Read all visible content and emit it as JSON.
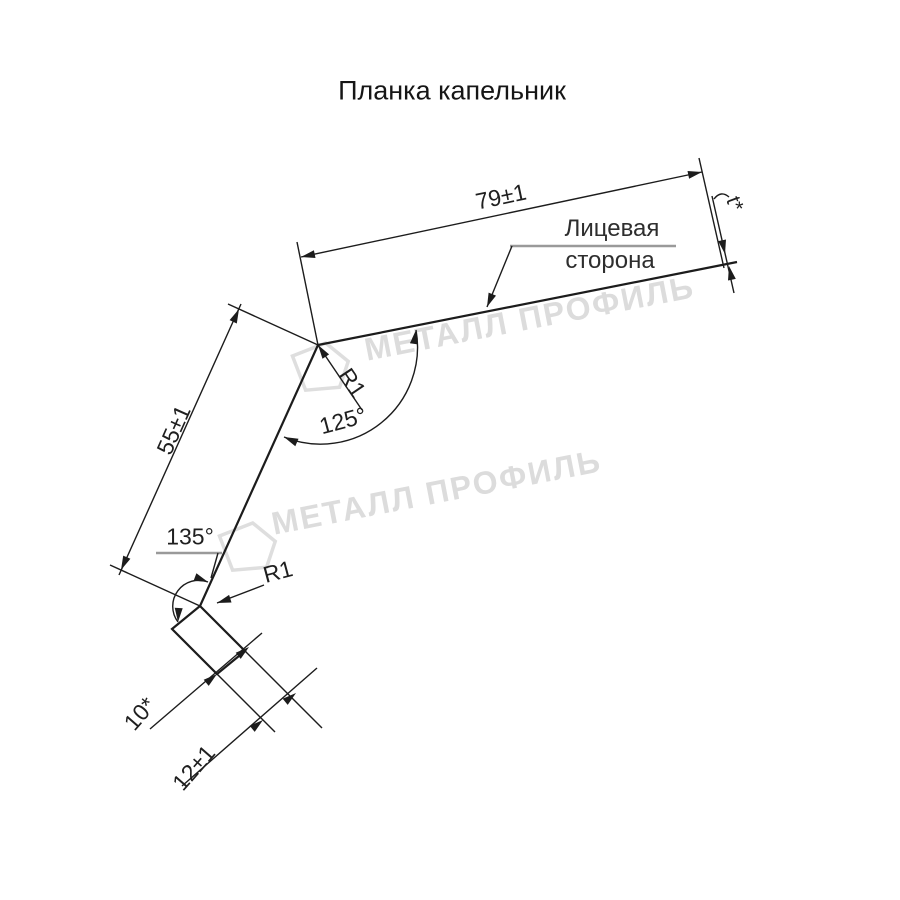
{
  "title": "Планка капельник",
  "profile": {
    "dimensions": {
      "top_flange": "79±1",
      "web": "55±1",
      "lip": "12±1",
      "hem": "10*",
      "thickness": "t*"
    },
    "angles": {
      "top_bend": "125°",
      "bottom_bend": "135°"
    },
    "radii": {
      "top_bend": "R1",
      "bottom_bend": "R1"
    },
    "face_side_label": {
      "line1": "Лицевая",
      "line2": "сторона"
    }
  },
  "watermark": {
    "text": "МЕТАЛЛ ПРОФИЛЬ",
    "logo_icon": "pentagon-logo",
    "color": "#dcdcdc"
  },
  "colors": {
    "line": "#1c1c1c",
    "shelf_line": "#9a9a9a",
    "background": "#ffffff"
  }
}
